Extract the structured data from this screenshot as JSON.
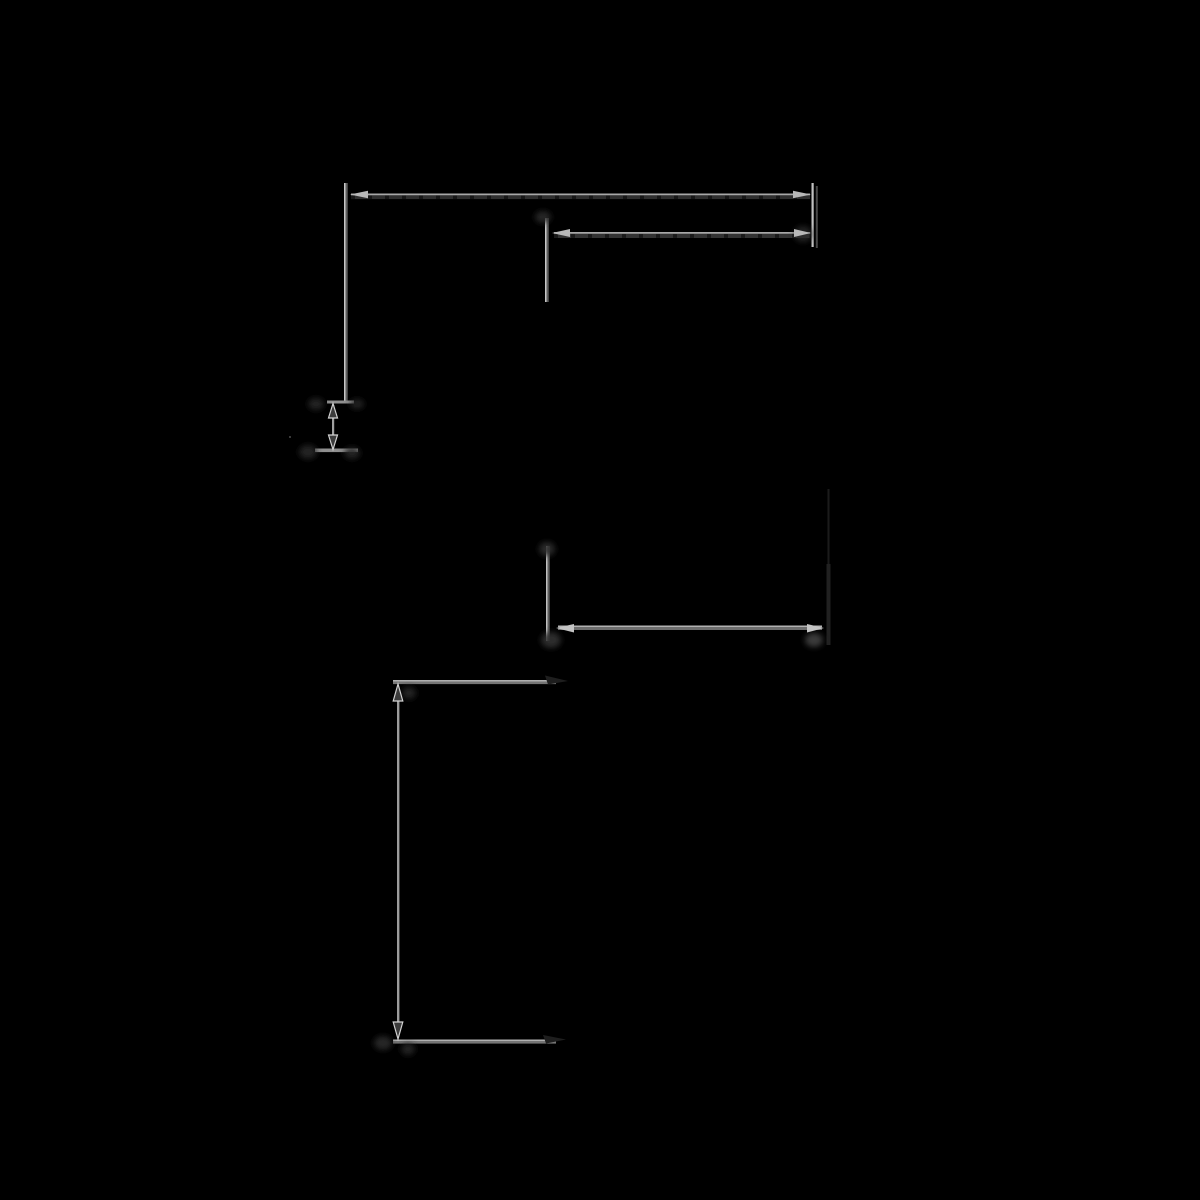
{
  "canvas": {
    "width": 1200,
    "height": 1200,
    "background": "#000000"
  },
  "colors": {
    "background": "#000000",
    "bright_line": "#a8a8a8",
    "highlight_line": "#c6c6c6",
    "mid_line": "#6e6e6e",
    "dark_band": "#303030",
    "notch": "#171717",
    "solid_arrow": "#b8b8b8",
    "hollow_arrow_stroke": "#d2d2d2",
    "hollow_arrow_fill": "#3c3c3c",
    "hidden_edge": "#1e1e1e",
    "smudge": "#2a2a2a"
  },
  "shapes": [
    {
      "name": "left-extension-line-highlight",
      "type": "rect",
      "x": 344,
      "y": 183,
      "w": 1.5,
      "h": 220,
      "fill": "#c6c6c6"
    },
    {
      "name": "left-extension-line",
      "type": "rect",
      "x": 345.5,
      "y": 183,
      "w": 2.2,
      "h": 220,
      "fill": "#5e5e5e"
    },
    {
      "name": "top-dimension-line",
      "type": "rect",
      "x": 351,
      "y": 193.5,
      "w": 459,
      "h": 1.8,
      "fill": "#a8a8a8"
    },
    {
      "name": "top-dimension-line-shadow",
      "type": "rect",
      "x": 351,
      "y": 195.5,
      "w": 459,
      "h": 3.6,
      "fill": "#2f2f2f"
    },
    {
      "name": "top-dimension-line-dashes",
      "type": "dashline",
      "x1": 351,
      "y1": 197.3,
      "x2": 810,
      "y2": 197.3,
      "stroke": "#171717",
      "width": 3.4,
      "dash": "4 13"
    },
    {
      "name": "right-extension-line",
      "type": "rect",
      "x": 811.5,
      "y": 183,
      "w": 2.2,
      "h": 64,
      "fill": "#c2c2c2"
    },
    {
      "name": "right-extension-line-shadow",
      "type": "rect",
      "x": 815.8,
      "y": 186,
      "w": 2,
      "h": 62,
      "fill": "#484848"
    },
    {
      "name": "upper-inner-dimension-line",
      "type": "rect",
      "x": 554,
      "y": 232,
      "w": 256,
      "h": 1.8,
      "fill": "#a8a8a8"
    },
    {
      "name": "upper-inner-dimension-line-shadow",
      "type": "rect",
      "x": 554,
      "y": 234,
      "w": 256,
      "h": 4,
      "fill": "#333333"
    },
    {
      "name": "upper-inner-dimension-line-dashes",
      "type": "dashline",
      "x1": 554,
      "y1": 236,
      "x2": 810,
      "y2": 236,
      "stroke": "#191919",
      "width": 3.8,
      "dash": "4 13"
    },
    {
      "name": "inner-extension-line-highlight",
      "type": "rect",
      "x": 545,
      "y": 218,
      "w": 1.5,
      "h": 84,
      "fill": "#c6c6c6"
    },
    {
      "name": "inner-extension-line",
      "type": "rect",
      "x": 546.5,
      "y": 218,
      "w": 2.2,
      "h": 84,
      "fill": "#5e5e5e"
    },
    {
      "name": "small-dimension-top-tick",
      "type": "rect",
      "x": 327,
      "y": 400.5,
      "w": 27,
      "h": 3,
      "fill": "#8f8f8f"
    },
    {
      "name": "small-dimension-bottom-tick",
      "type": "rect",
      "x": 315,
      "y": 448.5,
      "w": 43,
      "h": 3.6,
      "fill": "#8f8f8f"
    },
    {
      "name": "small-dimension-shaft",
      "type": "rect",
      "x": 332,
      "y": 405,
      "w": 2.2,
      "h": 43,
      "fill": "#a0a0a0"
    },
    {
      "name": "middle-dimension-line-highlight",
      "type": "rect",
      "x": 558,
      "y": 625.5,
      "w": 264,
      "h": 1.5,
      "fill": "#b2b2b2"
    },
    {
      "name": "middle-dimension-line",
      "type": "rect",
      "x": 558,
      "y": 627,
      "w": 264,
      "h": 3,
      "fill": "#6e6e6e"
    },
    {
      "name": "middle-left-extension-highlight",
      "type": "rect",
      "x": 546,
      "y": 546,
      "w": 1.5,
      "h": 95,
      "fill": "#c0c0c0"
    },
    {
      "name": "middle-left-extension-line",
      "type": "rect",
      "x": 547.5,
      "y": 546,
      "w": 2.2,
      "h": 95,
      "fill": "#5e5e5e"
    },
    {
      "name": "middle-right-hidden-edge-upper",
      "type": "rect",
      "x": 827.5,
      "y": 489,
      "w": 2,
      "h": 76,
      "fill": "#1b1b1b"
    },
    {
      "name": "middle-right-hidden-edge-lower",
      "type": "rect",
      "x": 826.5,
      "y": 564,
      "w": 4,
      "h": 81,
      "fill": "#212121"
    },
    {
      "name": "bottom-top-extension-highlight",
      "type": "rect",
      "x": 393,
      "y": 680,
      "w": 163,
      "h": 1.5,
      "fill": "#b0b0b0"
    },
    {
      "name": "bottom-top-extension-line",
      "type": "rect",
      "x": 393,
      "y": 681.5,
      "w": 163,
      "h": 2.6,
      "fill": "#757575"
    },
    {
      "name": "bottom-dimension-shaft",
      "type": "rect",
      "x": 397,
      "y": 687,
      "w": 2.4,
      "h": 349,
      "fill": "#9c9c9c"
    },
    {
      "name": "bottom-bottom-extension-highlight",
      "type": "rect",
      "x": 393,
      "y": 1039.5,
      "w": 163,
      "h": 1.5,
      "fill": "#b0b0b0"
    },
    {
      "name": "bottom-bottom-extension-line",
      "type": "rect",
      "x": 393,
      "y": 1041,
      "w": 163,
      "h": 2.6,
      "fill": "#757575"
    },
    {
      "name": "faint-dot",
      "type": "rect",
      "x": 289,
      "y": 436,
      "w": 2,
      "h": 2,
      "fill": "#3a3a3a"
    },
    {
      "name": "junction-smudge-inner-extension-top",
      "type": "blob",
      "cx": 543,
      "cy": 217,
      "rx": 8,
      "ry": 6,
      "fill": "#2a2a2a",
      "opacity": 0.9
    },
    {
      "name": "shadow-behind-right-arrows",
      "type": "blob",
      "cx": 803,
      "cy": 234,
      "rx": 9,
      "ry": 8,
      "fill": "#2c2c2c",
      "opacity": 0.8
    },
    {
      "name": "junction-smudge-small-tick-top-left",
      "type": "blob",
      "cx": 316,
      "cy": 404,
      "rx": 8,
      "ry": 6,
      "fill": "#282828",
      "opacity": 0.9
    },
    {
      "name": "junction-smudge-small-tick-top-right",
      "type": "blob",
      "cx": 357,
      "cy": 404,
      "rx": 7,
      "ry": 5,
      "fill": "#262626",
      "opacity": 0.9
    },
    {
      "name": "junction-smudge-small-tick-bottom-left",
      "type": "blob",
      "cx": 308,
      "cy": 452,
      "rx": 9,
      "ry": 7,
      "fill": "#282828",
      "opacity": 0.9
    },
    {
      "name": "junction-smudge-small-tick-bottom-right",
      "type": "blob",
      "cx": 352,
      "cy": 453,
      "rx": 8,
      "ry": 6,
      "fill": "#262626",
      "opacity": 0.9
    },
    {
      "name": "junction-smudge-middle-extension-top",
      "type": "blob",
      "cx": 547,
      "cy": 549,
      "rx": 8,
      "ry": 7,
      "fill": "#2e2e2e",
      "opacity": 0.9
    },
    {
      "name": "junction-smudge-middle-extension-bottom",
      "type": "blob",
      "cx": 551,
      "cy": 640,
      "rx": 10,
      "ry": 8,
      "fill": "#303030",
      "opacity": 0.9
    },
    {
      "name": "gray-smudge-middle-right-corner",
      "type": "blob",
      "cx": 814,
      "cy": 640,
      "rx": 9,
      "ry": 7,
      "fill": "#4a4a4a",
      "opacity": 0.8
    },
    {
      "name": "junction-smudge-bottom-arrow-top",
      "type": "blob",
      "cx": 409,
      "cy": 693,
      "rx": 7,
      "ry": 6,
      "fill": "#282828",
      "opacity": 0.9
    },
    {
      "name": "junction-smudge-bottom-corner-left",
      "type": "blob",
      "cx": 383,
      "cy": 1043,
      "rx": 9,
      "ry": 7,
      "fill": "#2a2a2a",
      "opacity": 0.9
    },
    {
      "name": "junction-smudge-bottom-corner-right",
      "type": "blob",
      "cx": 408,
      "cy": 1049,
      "rx": 7,
      "ry": 6,
      "fill": "#282828",
      "opacity": 0.9
    },
    {
      "name": "top-dimension-arrow-left",
      "type": "polygon",
      "points": "350,194.5 368,190.8 368,198.2",
      "fill": "#b8b8b8"
    },
    {
      "name": "top-dimension-arrow-right",
      "type": "polygon",
      "points": "811,194.5 793,190.8 793,198.2",
      "fill": "#b8b8b8"
    },
    {
      "name": "upper-inner-dimension-arrow-left",
      "type": "polygon",
      "points": "552,233 570,229 570,237",
      "fill": "#b8b8b8"
    },
    {
      "name": "upper-inner-dimension-arrow-right",
      "type": "polygon",
      "points": "811,233 794,229 794,237",
      "fill": "#b8b8b8"
    },
    {
      "name": "small-dimension-arrow-up",
      "type": "polygon",
      "points": "333,403.5 328.5,418 337.5,418",
      "fill": "#3c3c3c",
      "stroke": "#d2d2d2",
      "strokeWidth": 1.2
    },
    {
      "name": "small-dimension-arrow-down",
      "type": "polygon",
      "points": "333,449.5 328.5,435 337.5,435",
      "fill": "#3c3c3c",
      "stroke": "#d2d2d2",
      "strokeWidth": 1.2
    },
    {
      "name": "middle-dimension-arrow-left",
      "type": "polygon",
      "points": "556,628 574,624 574,632.5",
      "fill": "#c4c4c4"
    },
    {
      "name": "middle-dimension-arrow-right",
      "type": "polygon",
      "points": "824,628 807,624 807,632.5",
      "fill": "#c4c4c4"
    },
    {
      "name": "hidden-arrowhead-top-extension",
      "type": "polygon",
      "points": "568,681 545,675.5 548,684.5",
      "fill": "#1e1e1e"
    },
    {
      "name": "bottom-dimension-arrow-up",
      "type": "polygon",
      "points": "398,684 393.2,701 402.8,701",
      "fill": "#3c3c3c",
      "stroke": "#d2d2d2",
      "strokeWidth": 1.2
    },
    {
      "name": "bottom-dimension-arrow-down",
      "type": "polygon",
      "points": "398,1039 393.2,1022 402.8,1022",
      "fill": "#3c3c3c",
      "stroke": "#d2d2d2",
      "strokeWidth": 1.2
    },
    {
      "name": "hidden-arrowhead-bottom-extension",
      "type": "polygon",
      "points": "566,1039.5 543,1035 546,1043.5",
      "fill": "#1e1e1e"
    }
  ]
}
